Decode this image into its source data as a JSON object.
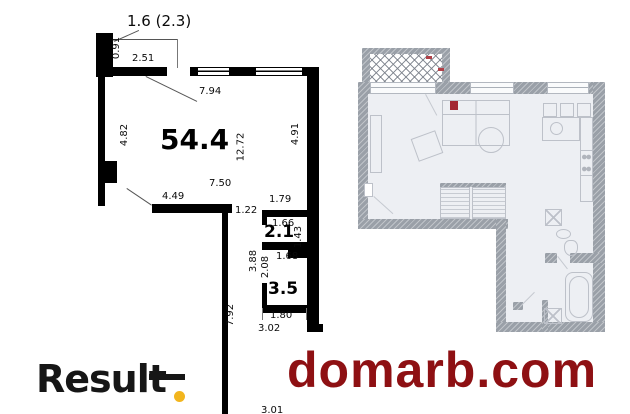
{
  "left_plan": {
    "area_label": "54.4",
    "balcony_label": "1.6 (2.3)",
    "room_labels": {
      "r21": "2.1",
      "r35": "3.5"
    },
    "dims": {
      "d091": "0.91",
      "d251": "2.51",
      "d794": "7.94",
      "d482": "4.82",
      "d1272": "12.72",
      "d491": "4.91",
      "d750": "7.50",
      "d449": "4.49",
      "d179": "1.79",
      "d122": "1.22",
      "d166": "1.66",
      "d143": "1.43",
      "d388": "3.88",
      "d208": "2.08",
      "d168": "1.68",
      "d792": "7.92",
      "d180": "1.80",
      "d302": "3.02",
      "d301": "3.01"
    },
    "wall_color": "#000000"
  },
  "right_plan": {
    "wall_color": "#9aa0a8",
    "floor_color": "#edeff3",
    "marker_color": "#a32733"
  },
  "branding": {
    "logo_text": "Result",
    "logo_color": "#161616",
    "logo_dot_color": "#f2b51d",
    "watermark_text": "domarb.com",
    "watermark_color": "#8e1013"
  }
}
